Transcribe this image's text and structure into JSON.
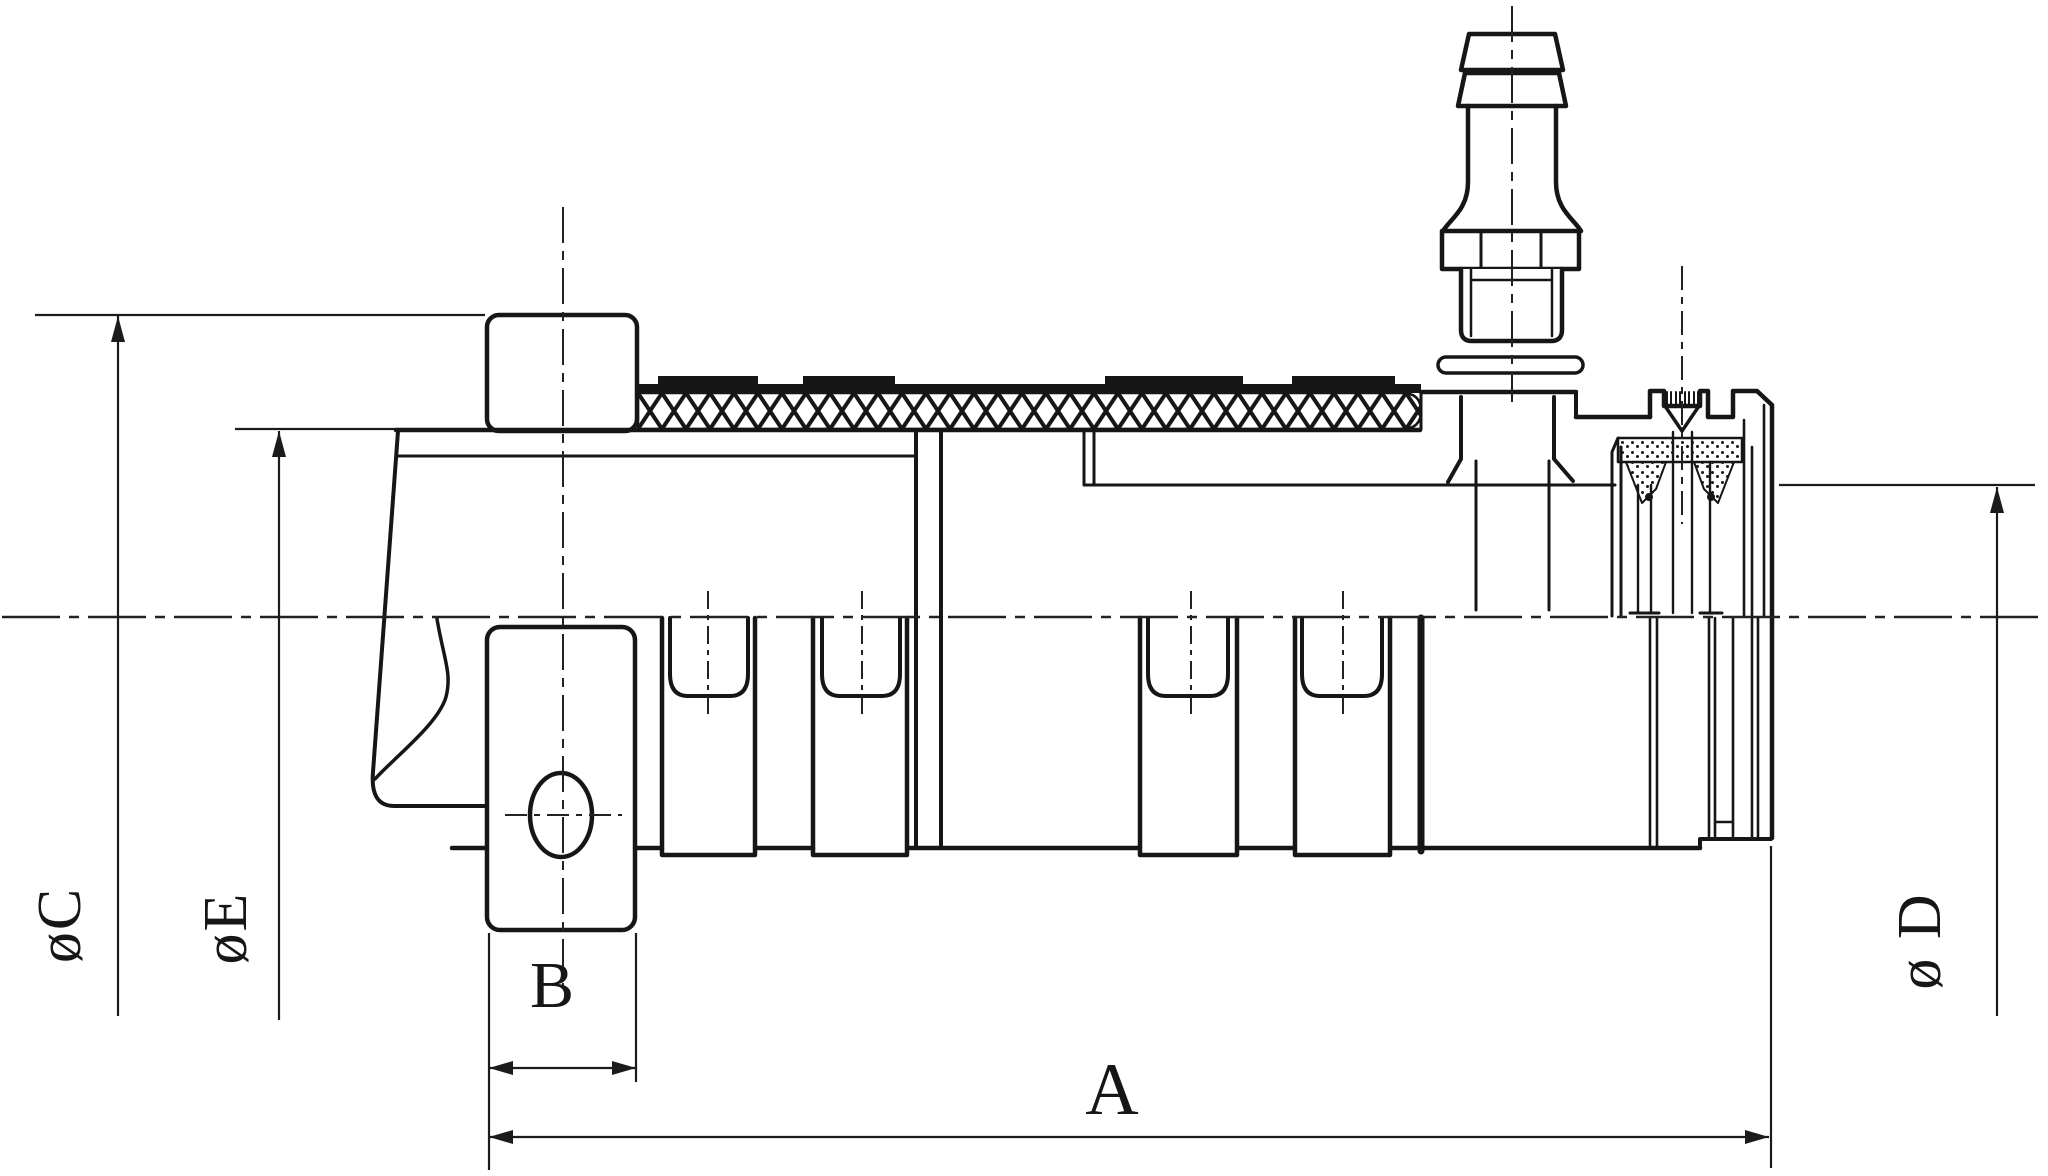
{
  "drawing": {
    "kind": "technical-section-drawing",
    "subject": "quick-connect hose coupling, side cross-section",
    "colors": {
      "background": "#ffffff",
      "line": "#161616"
    },
    "dimension_labels": {
      "c": "øC",
      "e": "øE",
      "d": "ø D",
      "b": "B",
      "a": "A"
    }
  }
}
